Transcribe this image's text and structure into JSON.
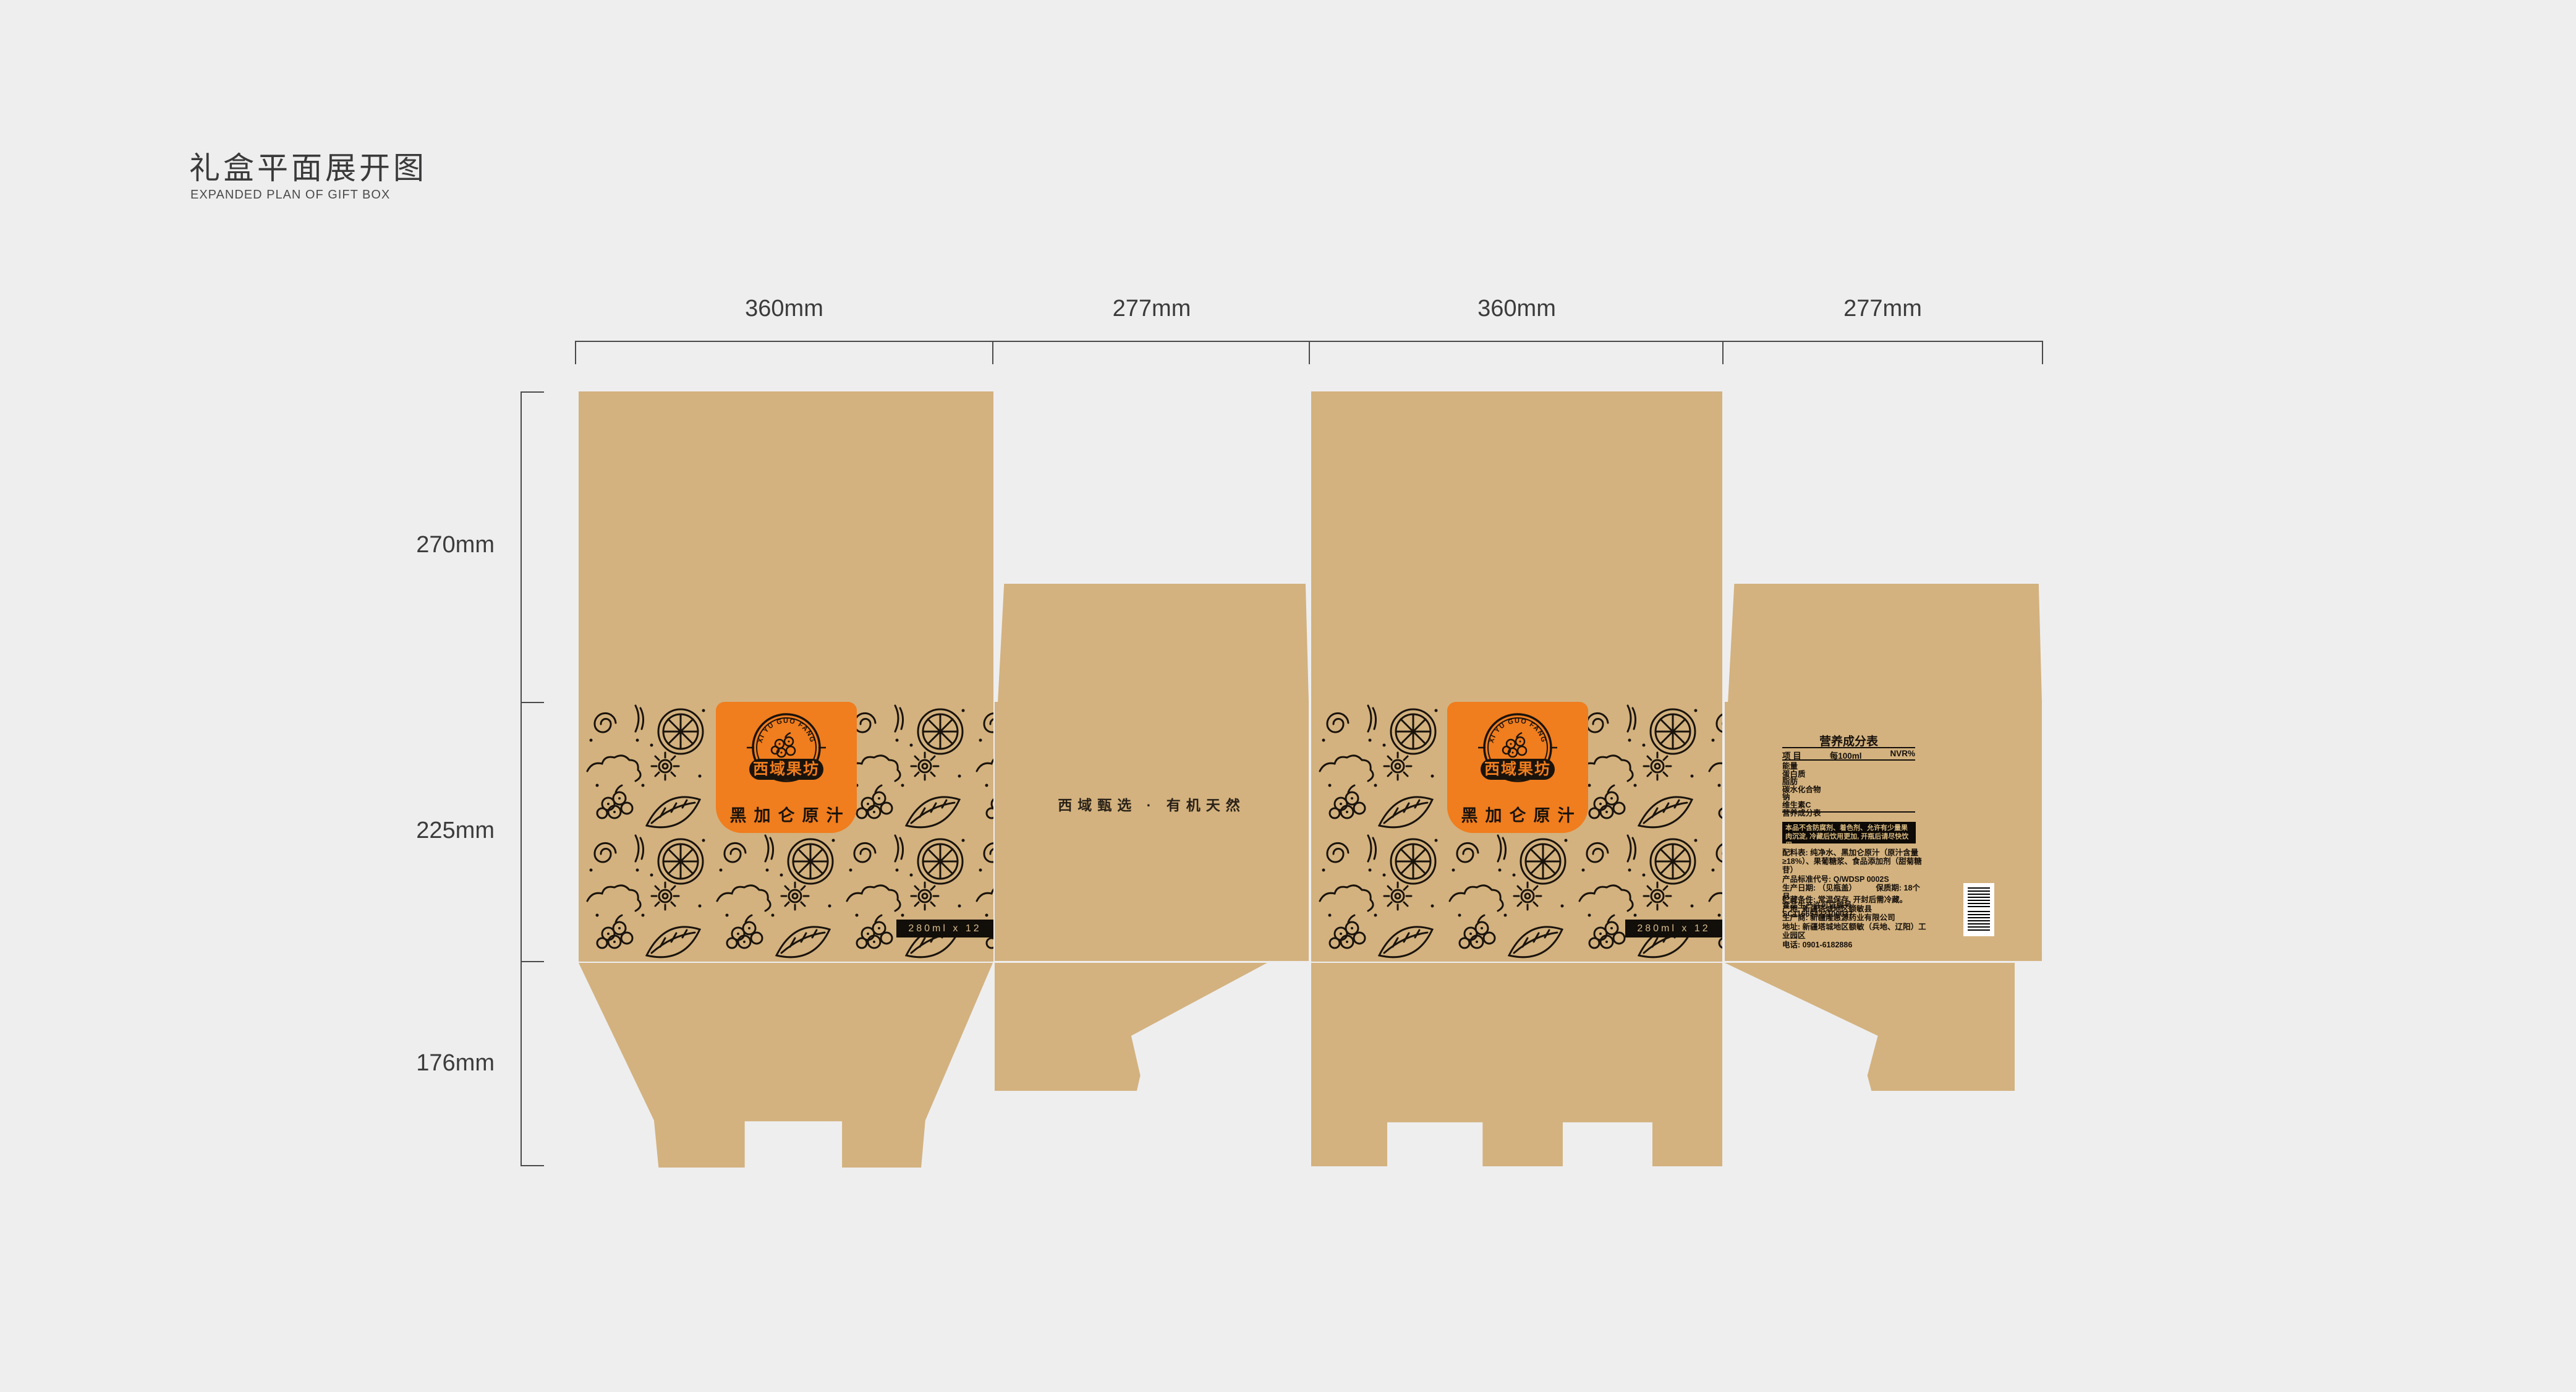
{
  "page": {
    "title": "礼盒平面展开图",
    "subtitle": "EXPANDED PLAN OF GIFT BOX"
  },
  "dimensions": {
    "top": [
      "360mm",
      "277mm",
      "360mm",
      "277mm"
    ],
    "left": [
      "270mm",
      "225mm",
      "176mm"
    ]
  },
  "brand": {
    "arc_text": "XI YU GUO FANG",
    "logo_name": "西域果坊",
    "product_name": "黑加仑原汁",
    "pack_spec": "280ml x 12"
  },
  "side_panel": {
    "slogan": "西域甄选 · 有机天然"
  },
  "info_panel": {
    "nutrition_title": "营养成分表",
    "nutrition_headers": [
      "项  目",
      "每100ml",
      "NVR%"
    ],
    "nutrition_rows": [
      "能量",
      "蛋白质",
      "脂肪",
      "碳水化合物",
      "钠",
      "维生素C",
      "营养成分表"
    ],
    "notice": "本品不含防腐剂、着色剂、允许有少量果肉沉淀, 冷藏后饮用更加, 开瓶后请尽快饮用。",
    "details": [
      "配料表: 纯净水、黑加仑原汁（原汁含量≥18%）、果葡糖浆、食品添加剂（甜菊糖苷）",
      "产品标准代号:  Q/WDSP 0002S",
      "生产日期: （见瓶盖）　　　保质期:  18个月",
      "食品生产许可证编号:  SC11565422100037"
    ],
    "details2": [
      "贮藏条件: 常温保存, 开封后需冷藏。",
      "产地: 新疆塔城地区额敏县",
      "生产商: 新疆隆惠源药业有限公司",
      "地址: 新疆塔城地区额敏（兵地、辽阳）工业园区",
      "电话: 0901-6182886"
    ]
  },
  "colors": {
    "background": "#eeeeef",
    "kraft": "#d3b27f",
    "ink": "#1a130c",
    "orange": "#f07d1e",
    "bar_text": "#d9be8e",
    "notice_text": "#d8b97f"
  }
}
